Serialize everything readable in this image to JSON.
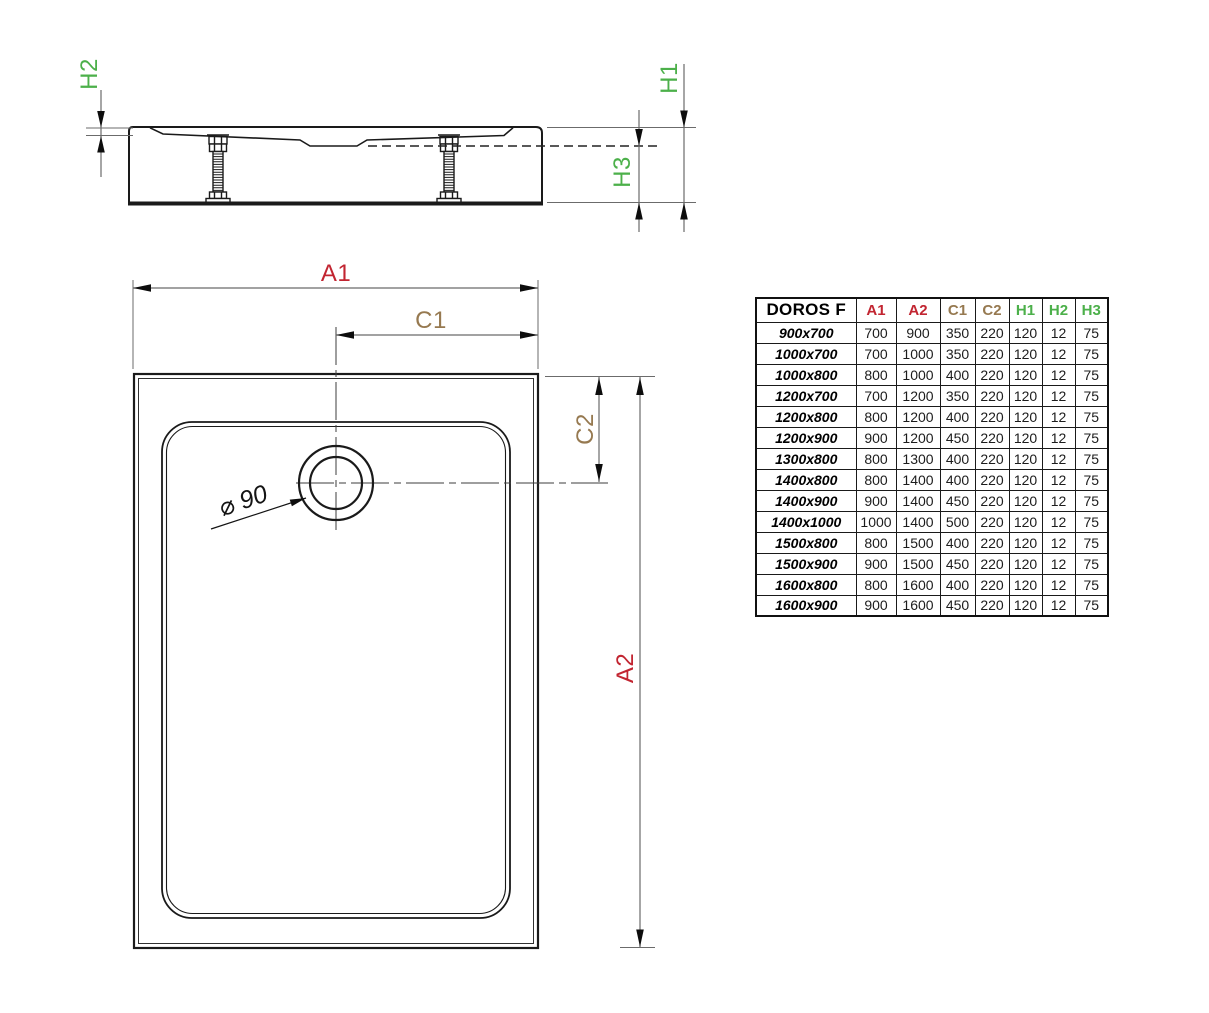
{
  "colors": {
    "red": "#c22531",
    "brown": "#967950",
    "green": "#4cb04a",
    "ink": "#1a1a1a",
    "dim_line": "#6b6b6b"
  },
  "side_view": {
    "labels": {
      "h1": "H1",
      "h2": "H2",
      "h3": "H3"
    }
  },
  "top_view": {
    "labels": {
      "a1": "A1",
      "a2": "A2",
      "c1": "C1",
      "c2": "C2",
      "drain_diameter": "⌀ 90"
    }
  },
  "table": {
    "title": "DOROS F",
    "headers": [
      {
        "label": "A1",
        "color": "#c22531"
      },
      {
        "label": "A2",
        "color": "#c22531"
      },
      {
        "label": "C1",
        "color": "#967950"
      },
      {
        "label": "C2",
        "color": "#967950"
      },
      {
        "label": "H1",
        "color": "#4cb04a"
      },
      {
        "label": "H2",
        "color": "#4cb04a"
      },
      {
        "label": "H3",
        "color": "#4cb04a"
      }
    ],
    "rows": [
      {
        "size": "900x700",
        "values": [
          "700",
          "900",
          "350",
          "220",
          "120",
          "12",
          "75"
        ]
      },
      {
        "size": "1000x700",
        "values": [
          "700",
          "1000",
          "350",
          "220",
          "120",
          "12",
          "75"
        ]
      },
      {
        "size": "1000x800",
        "values": [
          "800",
          "1000",
          "400",
          "220",
          "120",
          "12",
          "75"
        ]
      },
      {
        "size": "1200x700",
        "values": [
          "700",
          "1200",
          "350",
          "220",
          "120",
          "12",
          "75"
        ]
      },
      {
        "size": "1200x800",
        "values": [
          "800",
          "1200",
          "400",
          "220",
          "120",
          "12",
          "75"
        ]
      },
      {
        "size": "1200x900",
        "values": [
          "900",
          "1200",
          "450",
          "220",
          "120",
          "12",
          "75"
        ]
      },
      {
        "size": "1300x800",
        "values": [
          "800",
          "1300",
          "400",
          "220",
          "120",
          "12",
          "75"
        ]
      },
      {
        "size": "1400x800",
        "values": [
          "800",
          "1400",
          "400",
          "220",
          "120",
          "12",
          "75"
        ]
      },
      {
        "size": "1400x900",
        "values": [
          "900",
          "1400",
          "450",
          "220",
          "120",
          "12",
          "75"
        ]
      },
      {
        "size": "1400x1000",
        "values": [
          "1000",
          "1400",
          "500",
          "220",
          "120",
          "12",
          "75"
        ]
      },
      {
        "size": "1500x800",
        "values": [
          "800",
          "1500",
          "400",
          "220",
          "120",
          "12",
          "75"
        ]
      },
      {
        "size": "1500x900",
        "values": [
          "900",
          "1500",
          "450",
          "220",
          "120",
          "12",
          "75"
        ]
      },
      {
        "size": "1600x800",
        "values": [
          "800",
          "1600",
          "400",
          "220",
          "120",
          "12",
          "75"
        ]
      },
      {
        "size": "1600x900",
        "values": [
          "900",
          "1600",
          "450",
          "220",
          "120",
          "12",
          "75"
        ]
      }
    ]
  }
}
